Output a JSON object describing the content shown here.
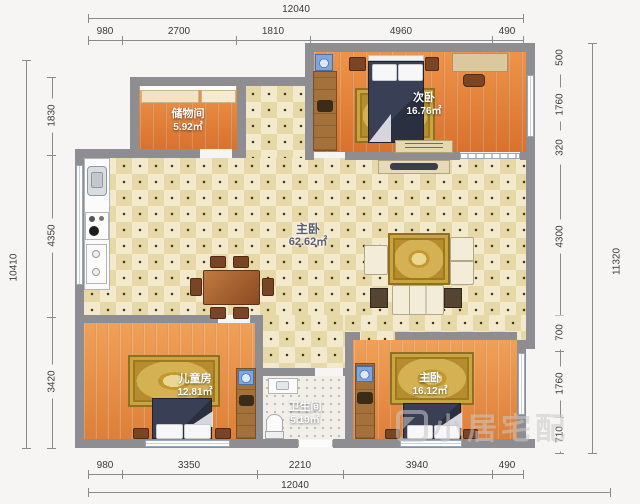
{
  "dimensions": {
    "top_total": "12040",
    "top_segments": [
      "980",
      "2700",
      "1810",
      "4960",
      "490"
    ],
    "bottom_segments": [
      "980",
      "3350",
      "2210",
      "3940",
      "490"
    ],
    "bottom_total": "12040",
    "left_total": "10410",
    "left_segments": [
      "1830",
      "4350",
      "3420"
    ],
    "right_total": "11320",
    "right_segments": [
      "500",
      "1760",
      "320",
      "4300",
      "700",
      "1760",
      "710"
    ]
  },
  "rooms": {
    "storage": {
      "name": "储物间",
      "area": "5.92㎡"
    },
    "secondary": {
      "name": "次卧",
      "area": "16.76㎡"
    },
    "living": {
      "name": "主卧",
      "area": "62.62㎡"
    },
    "kids": {
      "name": "儿童房",
      "area": "12.81㎡"
    },
    "bathroom": {
      "name": "卫生间",
      "area": "5.19㎡"
    },
    "master": {
      "name": "主卧",
      "area": "16.12㎡"
    }
  },
  "watermark": {
    "text": "小居宅配"
  },
  "colors": {
    "wall": "#8e8e92",
    "wood_floor": "#e08038",
    "tile_floor": "#e7d8a8",
    "rug_gold": "#c8a44b",
    "bed_dark": "#2e3340",
    "washer_blue": "#7fa7dd"
  }
}
